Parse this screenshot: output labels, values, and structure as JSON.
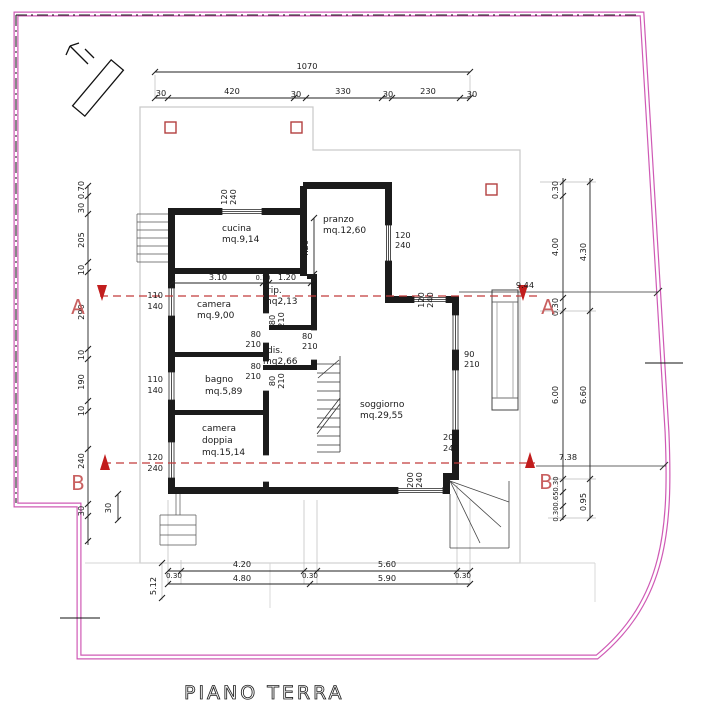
{
  "plan": {
    "floor_title": "PIANO TERRA",
    "rooms": [
      {
        "name": "cucina",
        "area": "mq.9,14"
      },
      {
        "name": "pranzo",
        "area": "mq.12,60"
      },
      {
        "name": "rip.",
        "area": "mq2,13"
      },
      {
        "name": "camera",
        "area": "mq.9,00"
      },
      {
        "name": "dis.",
        "area": "mq2,66"
      },
      {
        "name": "bagno",
        "area": "mq.5,89"
      },
      {
        "name": "camera doppia",
        "area": "mq.15,14"
      },
      {
        "name": "soggiorno",
        "area": "mq.29,55"
      }
    ],
    "sections": [
      {
        "id": "A",
        "span": "9.44"
      },
      {
        "id": "B",
        "span": "7.38"
      }
    ],
    "dimensions": {
      "top_total": "1070",
      "top_segments": [
        "30",
        "420",
        "30",
        "330",
        "30",
        "230",
        "30"
      ],
      "left_chain": [
        "0.70",
        "30",
        "205",
        "10",
        "290",
        "10",
        "190",
        "10",
        "240",
        "30"
      ],
      "right_inner_chain": [
        "0.30",
        "4.00",
        "0.30",
        "6.00",
        "0.30",
        "0.65",
        "0.30"
      ],
      "right_outer_chain": [
        "4.30",
        "6.60",
        "0.95"
      ],
      "bottom_row1": [
        "0.30",
        "4.20",
        "0.30",
        "5.60",
        "0.30"
      ],
      "bottom_row2": [
        "4.80",
        "5.90"
      ],
      "bottom_left_vertical": "5.12",
      "interior": [
        "3.10",
        "0.10",
        "1.20",
        "4.20",
        "30"
      ]
    },
    "openings": [
      "120/240",
      "110/140",
      "80/210",
      "90/210",
      "200/240"
    ],
    "colors": {
      "boundary_pink": "#cf5ab5",
      "section_red": "#c23b3b",
      "pillar_red": "#b34040",
      "wall_black": "#1b1b1b"
    }
  },
  "labels": [
    {
      "t": "1070",
      "x": 307,
      "y": 69,
      "a": "middle"
    },
    {
      "t": "30",
      "x": 161,
      "y": 96,
      "a": "middle"
    },
    {
      "t": "420",
      "x": 232,
      "y": 94,
      "a": "middle"
    },
    {
      "t": "30",
      "x": 296,
      "y": 97,
      "a": "middle"
    },
    {
      "t": "330",
      "x": 343,
      "y": 94,
      "a": "middle"
    },
    {
      "t": "30",
      "x": 388,
      "y": 97,
      "a": "middle"
    },
    {
      "t": "230",
      "x": 428,
      "y": 94,
      "a": "middle"
    },
    {
      "t": "30",
      "x": 472,
      "y": 97,
      "a": "middle"
    },
    {
      "t": "0.70",
      "x": 84,
      "y": 190,
      "r": -90,
      "a": "middle"
    },
    {
      "t": "30",
      "x": 84,
      "y": 208,
      "r": -90,
      "a": "middle"
    },
    {
      "t": "205",
      "x": 84,
      "y": 240,
      "r": -90,
      "a": "middle"
    },
    {
      "t": "10",
      "x": 84,
      "y": 270,
      "r": -90,
      "a": "middle"
    },
    {
      "t": "290",
      "x": 84,
      "y": 312,
      "r": -90,
      "a": "middle"
    },
    {
      "t": "10",
      "x": 84,
      "y": 355,
      "r": -90,
      "a": "middle"
    },
    {
      "t": "190",
      "x": 84,
      "y": 382,
      "r": -90,
      "a": "middle"
    },
    {
      "t": "10",
      "x": 84,
      "y": 411,
      "r": -90,
      "a": "middle"
    },
    {
      "t": "240",
      "x": 84,
      "y": 461,
      "r": -90,
      "a": "middle"
    },
    {
      "t": "30",
      "x": 84,
      "y": 511,
      "r": -90,
      "a": "middle"
    },
    {
      "t": "0.30",
      "x": 558,
      "y": 190,
      "r": -90,
      "a": "middle"
    },
    {
      "t": "4.00",
      "x": 558,
      "y": 247,
      "r": -90,
      "a": "middle"
    },
    {
      "t": "0.30",
      "x": 558,
      "y": 307,
      "r": -90,
      "a": "middle"
    },
    {
      "t": "6.00",
      "x": 558,
      "y": 395,
      "r": -90,
      "a": "middle"
    },
    {
      "t": "0.30",
      "x": 558,
      "y": 484,
      "r": -90,
      "a": "middle",
      "s": 6.8
    },
    {
      "t": "0.65",
      "x": 558,
      "y": 499,
      "r": -90,
      "a": "middle",
      "s": 6.8
    },
    {
      "t": "0.30",
      "x": 558,
      "y": 514,
      "r": -90,
      "a": "middle",
      "s": 6.8
    },
    {
      "t": "4.30",
      "x": 586,
      "y": 252,
      "r": -90,
      "a": "middle"
    },
    {
      "t": "6.60",
      "x": 586,
      "y": 395,
      "r": -90,
      "a": "middle"
    },
    {
      "t": "0.95",
      "x": 586,
      "y": 502,
      "r": -90,
      "a": "middle"
    },
    {
      "t": "4.20",
      "x": 242,
      "y": 567,
      "a": "middle"
    },
    {
      "t": "5.60",
      "x": 387,
      "y": 567,
      "a": "middle"
    },
    {
      "t": "0.30",
      "x": 174,
      "y": 578,
      "a": "middle",
      "s": 7.2
    },
    {
      "t": "0.30",
      "x": 310,
      "y": 578,
      "a": "middle",
      "s": 7.2
    },
    {
      "t": "0.30",
      "x": 463,
      "y": 578,
      "a": "middle",
      "s": 7.2
    },
    {
      "t": "4.80",
      "x": 242,
      "y": 581,
      "a": "middle"
    },
    {
      "t": "5.90",
      "x": 387,
      "y": 581,
      "a": "middle"
    },
    {
      "t": "5.12",
      "x": 156,
      "y": 586,
      "r": -90,
      "a": "middle"
    },
    {
      "t": "9.44",
      "x": 525,
      "y": 288,
      "a": "middle"
    },
    {
      "t": "7.38",
      "x": 568,
      "y": 460,
      "a": "middle"
    },
    {
      "t": "A",
      "x": 78,
      "y": 314,
      "a": "middle",
      "s": 20,
      "c": "#c96060",
      "n": "section-letter"
    },
    {
      "t": "A",
      "x": 548,
      "y": 314,
      "a": "middle",
      "s": 20,
      "c": "#c96060",
      "n": "section-letter"
    },
    {
      "t": "B",
      "x": 78,
      "y": 490,
      "a": "middle",
      "s": 20,
      "c": "#c96060",
      "n": "section-letter"
    },
    {
      "t": "B",
      "x": 546,
      "y": 489,
      "a": "middle",
      "s": 20,
      "c": "#c96060",
      "n": "section-letter"
    },
    {
      "t": "3.10",
      "x": 218,
      "y": 280,
      "a": "middle"
    },
    {
      "t": "0.10",
      "x": 263,
      "y": 280,
      "a": "middle",
      "s": 6.6
    },
    {
      "t": "1.20",
      "x": 287,
      "y": 280,
      "a": "middle"
    },
    {
      "t": "4.20",
      "x": 308,
      "y": 249,
      "r": -90,
      "a": "middle"
    },
    {
      "t": "30",
      "x": 111,
      "y": 508,
      "r": -90,
      "a": "middle"
    },
    {
      "t": "120",
      "x": 227,
      "y": 197,
      "r": -90,
      "a": "middle"
    },
    {
      "t": "240",
      "x": 236,
      "y": 197,
      "r": -90,
      "a": "middle"
    },
    {
      "t": "120",
      "x": 395,
      "y": 238
    },
    {
      "t": "240",
      "x": 395,
      "y": 248
    },
    {
      "t": "120",
      "x": 424,
      "y": 300,
      "r": -90,
      "a": "middle"
    },
    {
      "t": "240",
      "x": 433,
      "y": 300,
      "r": -90,
      "a": "middle"
    },
    {
      "t": "110",
      "x": 163,
      "y": 298,
      "a": "end"
    },
    {
      "t": "140",
      "x": 163,
      "y": 309,
      "a": "end"
    },
    {
      "t": "110",
      "x": 163,
      "y": 382,
      "a": "end"
    },
    {
      "t": "140",
      "x": 163,
      "y": 393,
      "a": "end"
    },
    {
      "t": "120",
      "x": 163,
      "y": 460,
      "a": "end"
    },
    {
      "t": "240",
      "x": 163,
      "y": 471,
      "a": "end"
    },
    {
      "t": "80",
      "x": 261,
      "y": 337,
      "a": "end"
    },
    {
      "t": "210",
      "x": 261,
      "y": 347,
      "a": "end"
    },
    {
      "t": "80",
      "x": 261,
      "y": 369,
      "a": "end"
    },
    {
      "t": "210",
      "x": 261,
      "y": 379,
      "a": "end"
    },
    {
      "t": "80",
      "x": 275,
      "y": 320,
      "r": -90,
      "a": "middle"
    },
    {
      "t": "210",
      "x": 284,
      "y": 320,
      "r": -90,
      "a": "middle"
    },
    {
      "t": "80",
      "x": 275,
      "y": 381,
      "r": -90,
      "a": "middle"
    },
    {
      "t": "210",
      "x": 284,
      "y": 381,
      "r": -90,
      "a": "middle"
    },
    {
      "t": "80",
      "x": 302,
      "y": 339
    },
    {
      "t": "210",
      "x": 302,
      "y": 349
    },
    {
      "t": "90",
      "x": 464,
      "y": 357
    },
    {
      "t": "210",
      "x": 464,
      "y": 367
    },
    {
      "t": "200",
      "x": 443,
      "y": 440
    },
    {
      "t": "240",
      "x": 443,
      "y": 451
    },
    {
      "t": "200",
      "x": 413,
      "y": 480,
      "r": -90,
      "a": "middle"
    },
    {
      "t": "240",
      "x": 422,
      "y": 480,
      "r": -90,
      "a": "middle"
    },
    {
      "t": "cucina",
      "x": 222,
      "y": 231,
      "s": 9,
      "n": "room-label"
    },
    {
      "t": "mq.9,14",
      "x": 222,
      "y": 242,
      "s": 9,
      "n": "room-label"
    },
    {
      "t": "pranzo",
      "x": 323,
      "y": 222,
      "s": 9,
      "n": "room-label"
    },
    {
      "t": "mq.12,60",
      "x": 323,
      "y": 233,
      "s": 9,
      "n": "room-label"
    },
    {
      "t": "rip.",
      "x": 267,
      "y": 293,
      "s": 9,
      "n": "room-label"
    },
    {
      "t": "mq2,13",
      "x": 263,
      "y": 304,
      "s": 9,
      "n": "room-label"
    },
    {
      "t": "camera",
      "x": 197,
      "y": 307,
      "s": 9,
      "n": "room-label"
    },
    {
      "t": "mq.9,00",
      "x": 197,
      "y": 318,
      "s": 9,
      "n": "room-label"
    },
    {
      "t": "dis.",
      "x": 267,
      "y": 353,
      "s": 9,
      "n": "room-label"
    },
    {
      "t": "mq2,66",
      "x": 263,
      "y": 364,
      "s": 9,
      "n": "room-label"
    },
    {
      "t": "bagno",
      "x": 205,
      "y": 382,
      "s": 9,
      "n": "room-label"
    },
    {
      "t": "mq.5,89",
      "x": 205,
      "y": 394,
      "s": 9,
      "n": "room-label"
    },
    {
      "t": "camera",
      "x": 202,
      "y": 431,
      "s": 9,
      "n": "room-label"
    },
    {
      "t": "doppia",
      "x": 202,
      "y": 443,
      "s": 9,
      "n": "room-label"
    },
    {
      "t": "mq.15,14",
      "x": 202,
      "y": 455,
      "s": 9,
      "n": "room-label"
    },
    {
      "t": "soggiorno",
      "x": 360,
      "y": 407,
      "s": 9,
      "n": "room-label"
    },
    {
      "t": "mq.29,55",
      "x": 360,
      "y": 418,
      "s": 9,
      "n": "room-label"
    }
  ]
}
